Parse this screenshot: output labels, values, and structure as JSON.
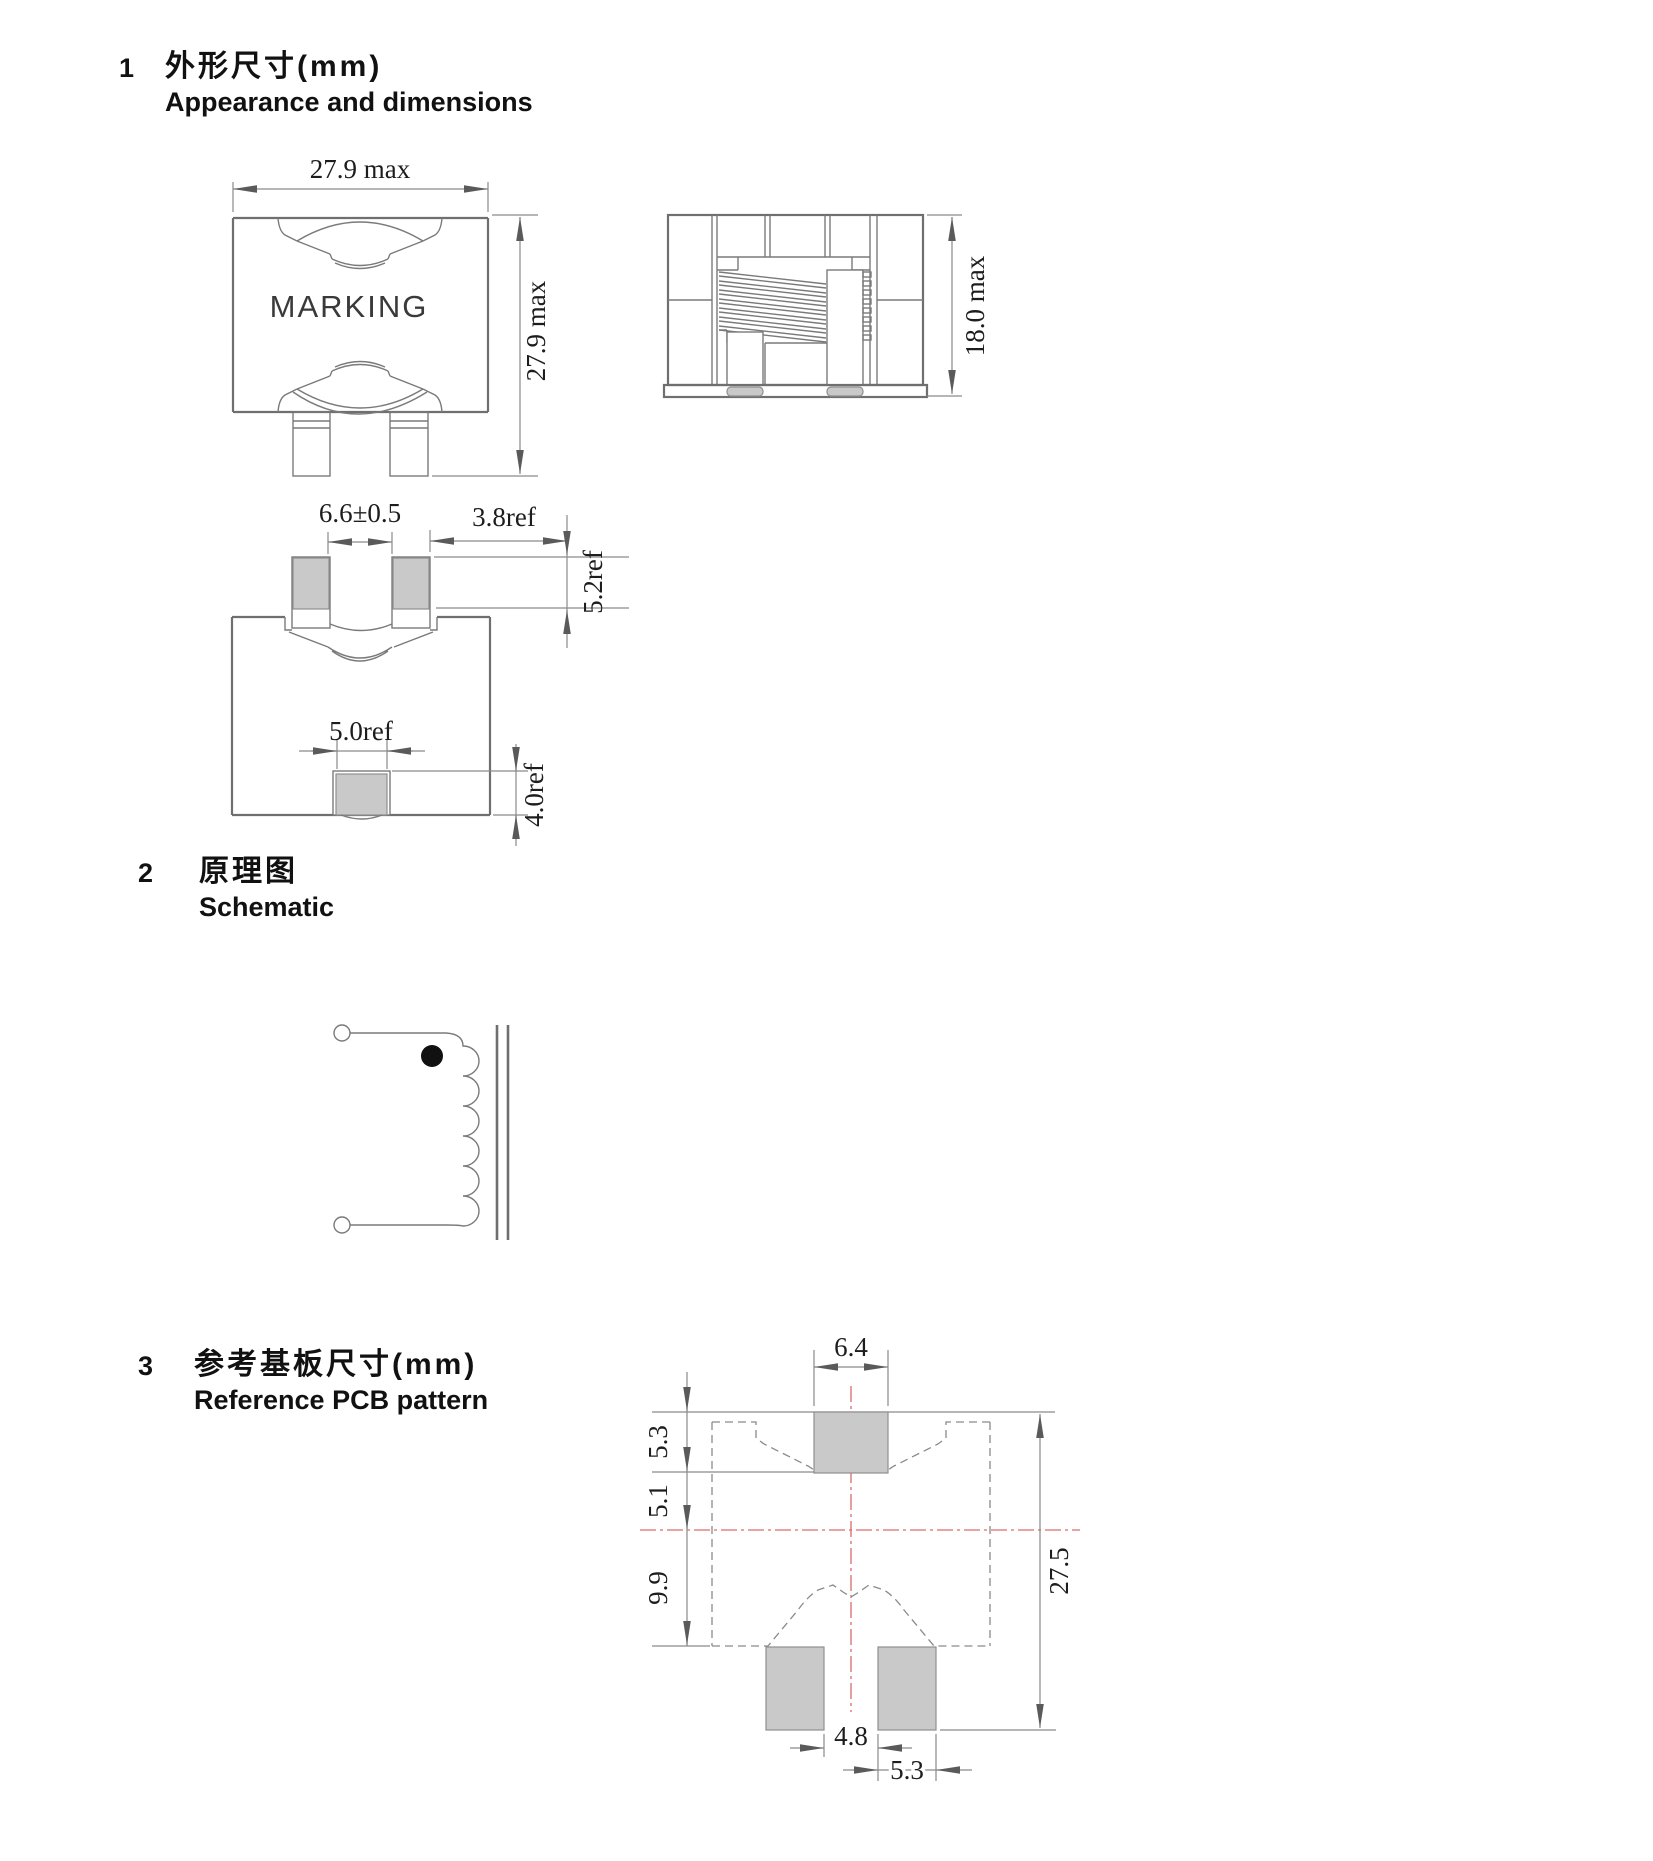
{
  "sections": {
    "s1": {
      "number": "1",
      "title_zh": "外形尺寸(mm)",
      "title_en": "Appearance and dimensions"
    },
    "s2": {
      "number": "2",
      "title_zh": "原理图",
      "title_en": "Schematic"
    },
    "s3": {
      "number": "3",
      "title_zh": "参考基板尺寸(mm)",
      "title_en": "Reference PCB pattern"
    }
  },
  "front_view": {
    "marking": "MARKING",
    "width_dim": "27.9 max",
    "height_dim": "27.9 max"
  },
  "side_view": {
    "height_dim": "18.0 max"
  },
  "bottom_view": {
    "pad_span_dim": "6.6±0.5",
    "pad_side_dim": "3.8ref",
    "pad_height_dim": "5.2ref",
    "center_pad_width_dim": "5.0ref",
    "center_pad_height_dim": "4.0ref"
  },
  "pcb": {
    "top_pad_width_dim": "6.4",
    "top_pad_height_dim": "5.3",
    "pad_to_center_dim": "5.1",
    "center_to_bottom_dim": "9.9",
    "overall_height_dim": "27.5",
    "bottom_gap_dim": "4.8",
    "bottom_pad_width_dim": "5.3"
  },
  "colors": {
    "drawing_line": "#7a7a7a",
    "pad_fill": "#c9c9c9",
    "centerline_red": "#dd6a6a",
    "text": "#1d1d1d"
  }
}
